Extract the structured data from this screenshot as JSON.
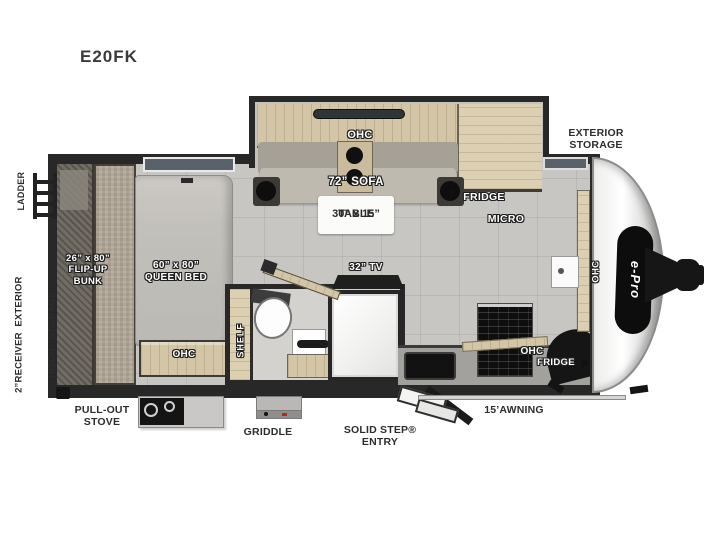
{
  "title": "E20FK",
  "brand_logo": "e-Pro",
  "colors": {
    "wall": "#282828",
    "floor": "#c7c6c3",
    "wood": "#d3c5a6",
    "label_dark": "#2d2d2d",
    "label_light": "#ffffff"
  },
  "rear": {
    "ladder_label": "LADDER",
    "hitch_storage_line1": "2”RECEIVER  EXTERIOR",
    "hitch_storage_line2": "HITCH   STORAGE"
  },
  "bedroom": {
    "bunk_line1": "26” x 80”",
    "bunk_line2": "FLIP-UP",
    "bunk_line3": "BUNK",
    "queen_line1": "60” x 80”",
    "queen_line2": "QUEEN BED",
    "foot_cabinet": "OHC"
  },
  "bathroom": {
    "shelf_label": "SHELF",
    "tv_label": "32” TV"
  },
  "slide_out": {
    "ohc_label": "OHC",
    "sofa_label": "72” SOFA",
    "table_line1": "30” x 15”",
    "table_line2": "TABLE"
  },
  "galley": {
    "fridge_upper_label": "FRIDGE",
    "micro_label": "MICRO",
    "ohc_label": "OHC",
    "fridge_lower_label": "FRIDGE",
    "front_ohc_label": "OHC"
  },
  "exterior": {
    "storage_line1": "EXTERIOR",
    "storage_line2": "STORAGE",
    "stove_line1": "PULL-OUT",
    "stove_line2": "STOVE",
    "griddle_label": "GRIDDLE",
    "step_line1": "SOLID STEP®",
    "step_line2": "ENTRY",
    "awning_label": "15’AWNING"
  }
}
